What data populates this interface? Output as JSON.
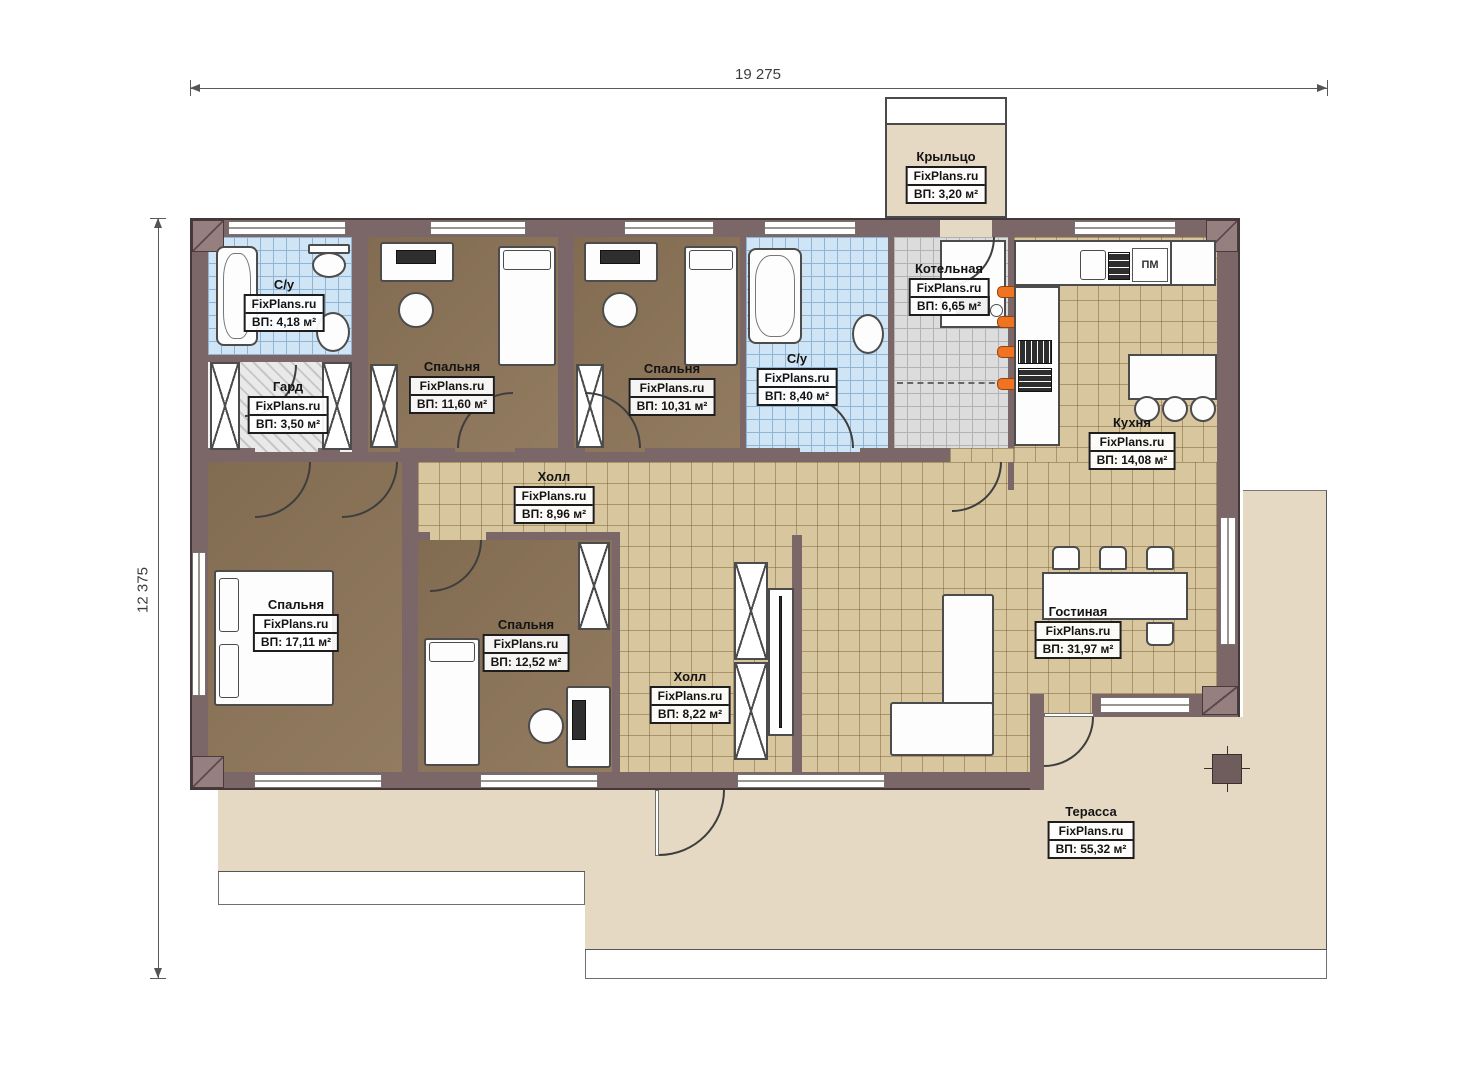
{
  "brand": "FixPlans.ru",
  "dimensions": {
    "width": "19 275",
    "height": "12 375"
  },
  "labels": {
    "dishwasher": "ПМ"
  },
  "rooms": [
    {
      "id": "porch",
      "name": "Крыльцо",
      "area": "ВП: 3,20 м²"
    },
    {
      "id": "bath1",
      "name": "С/у",
      "area": "ВП: 4,18 м²"
    },
    {
      "id": "wardrobe",
      "name": "Гард",
      "area": "ВП: 3,50 м²"
    },
    {
      "id": "bedroom1",
      "name": "Спальня",
      "area": "ВП: 11,60 м²"
    },
    {
      "id": "bedroom2",
      "name": "Спальня",
      "area": "ВП: 10,31 м²"
    },
    {
      "id": "bath2",
      "name": "С/у",
      "area": "ВП: 8,40 м²"
    },
    {
      "id": "boiler",
      "name": "Котельная",
      "area": "ВП: 6,65 м²"
    },
    {
      "id": "kitchen",
      "name": "Кухня",
      "area": "ВП: 14,08 м²"
    },
    {
      "id": "hall1",
      "name": "Холл",
      "area": "ВП: 8,96 м²"
    },
    {
      "id": "bedroom3",
      "name": "Спальня",
      "area": "ВП: 17,11 м²"
    },
    {
      "id": "bedroom4",
      "name": "Спальня",
      "area": "ВП: 12,52 м²"
    },
    {
      "id": "hall2",
      "name": "Холл",
      "area": "ВП: 8,22 м²"
    },
    {
      "id": "living",
      "name": "Гостиная",
      "area": "ВП: 31,97 м²"
    },
    {
      "id": "terrace",
      "name": "Терасса",
      "area": "ВП: 55,32 м²"
    }
  ]
}
